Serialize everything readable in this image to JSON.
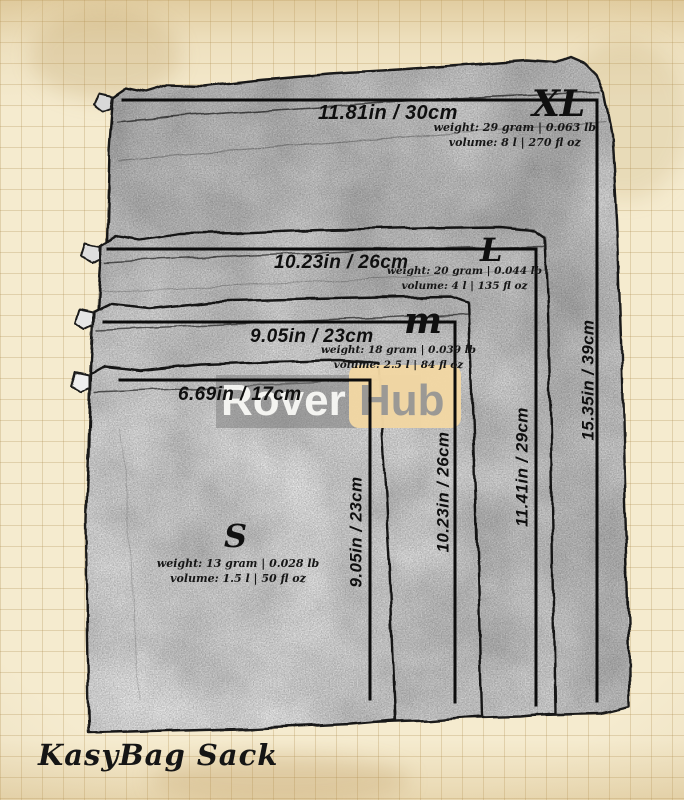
{
  "brand": {
    "name": "KasyBag Sack"
  },
  "watermark": {
    "left": "Rover",
    "right": "Hub"
  },
  "sizes": {
    "xl": {
      "letter": "XL",
      "width": "11.81in / 30cm",
      "height": "15.35in / 39cm",
      "weight": "weight: 29 gram | 0.063 lb",
      "volume": "volume: 8 l | 270 fl oz"
    },
    "l": {
      "letter": "L",
      "width": "10.23in / 26cm",
      "height": "11.41in / 29cm",
      "weight": "weight: 20 gram | 0.044 lb",
      "volume": "volume: 4 l | 135 fl oz"
    },
    "m": {
      "letter": "m",
      "width": "9.05in / 23cm",
      "height": "10.23in / 26cm",
      "weight": "weight: 18 gram | 0.039 lb",
      "volume": "volume: 2.5 l | 84 fl oz"
    },
    "s": {
      "letter": "S",
      "width": "6.69in / 17cm",
      "height": "9.05in / 23cm",
      "weight": "weight: 13 gram | 0.028 lb",
      "volume": "volume: 1.5 l | 50 fl oz"
    }
  },
  "colors": {
    "paper": "#f5ebcf",
    "grid_line": "#c9ad79",
    "ink": "#0f0f0f",
    "bag_fill_back": "#d8d8d8",
    "bag_fill_front": "#efefef",
    "watermark_band": "#7a7a7a",
    "watermark_text": "#fcfcf9",
    "hub_badge": "#f2d7a3",
    "hub_text": "#949494"
  }
}
